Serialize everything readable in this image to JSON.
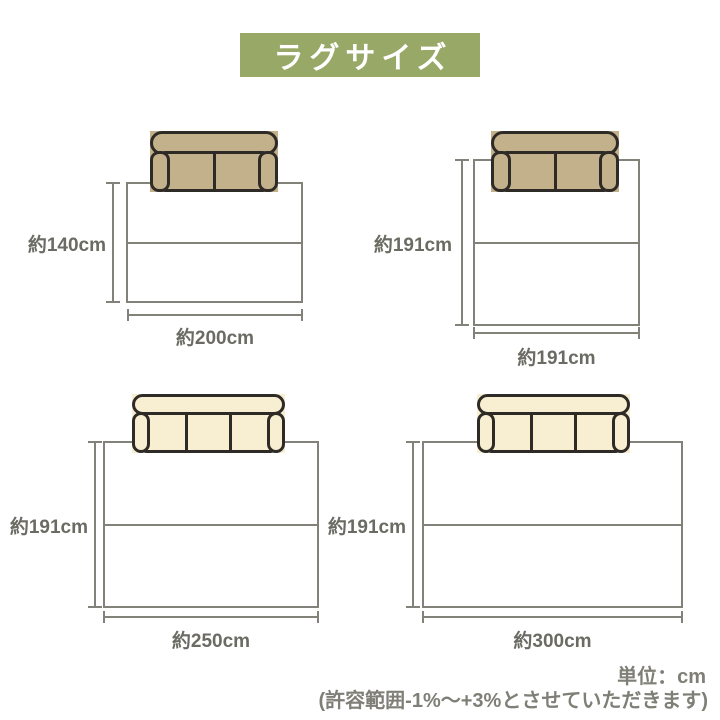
{
  "title": "ラグサイズ",
  "colors": {
    "banner_green": "#97a867",
    "sofa_tan": "#c3b18c",
    "sofa_cream": "#f8efd2",
    "sofa_outline": "#2e2b27",
    "line_gray": "#82827b",
    "label_text": "#6b6b64",
    "footer_text": "#7f7f77"
  },
  "diagrams": [
    {
      "position": "top-left",
      "height_label": "約140cm",
      "width_label": "約200cm",
      "height_cm": 140,
      "width_cm": 200,
      "sofa_type": "2-seater",
      "sofa_color": "#c3b18c"
    },
    {
      "position": "top-right",
      "height_label": "約191cm",
      "width_label": "約191cm",
      "height_cm": 191,
      "width_cm": 191,
      "sofa_type": "2-seater",
      "sofa_color": "#c3b18c"
    },
    {
      "position": "bottom-left",
      "height_label": "約191cm",
      "width_label": "約250cm",
      "height_cm": 191,
      "width_cm": 250,
      "sofa_type": "3-seater",
      "sofa_color": "#f8efd2"
    },
    {
      "position": "bottom-right",
      "height_label": "約191cm",
      "width_label": "約300cm",
      "height_cm": 191,
      "width_cm": 300,
      "sofa_type": "3-seater",
      "sofa_color": "#f8efd2"
    }
  ],
  "footer": {
    "unit_label": "単位：cm",
    "tolerance_note": "(許容範囲-1%〜+3%とさせていただきます)"
  }
}
